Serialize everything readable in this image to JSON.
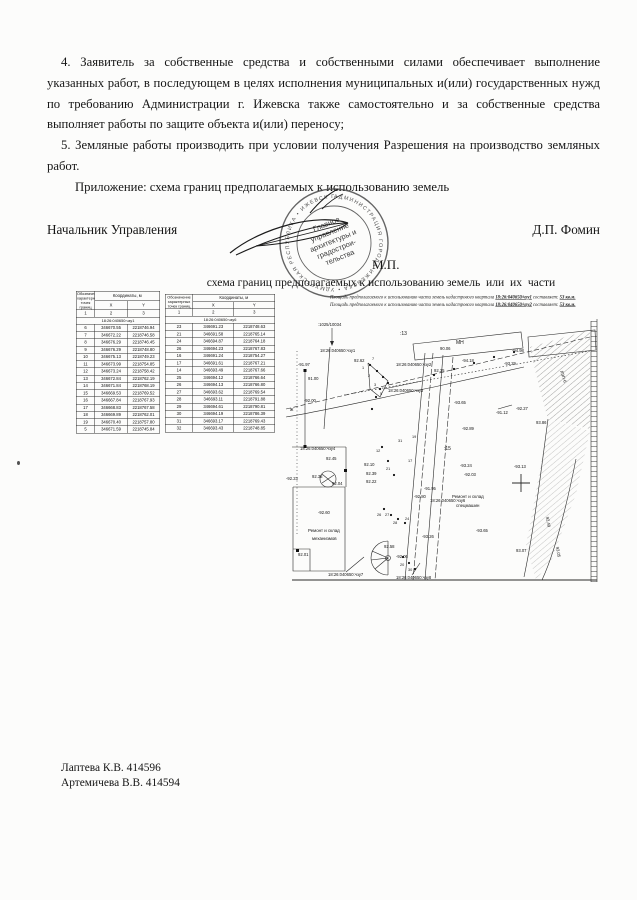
{
  "document": {
    "paragraph_4": "4. Заявитель за собственные средства и собственными силами обеспечивает выполнение указанных работ, в последующем в целях исполнения муниципальных и(или) государственных нужд по требованию Администрации г. Ижевска также самостоятельно и за собственные средства выполняет работы по защите объекта и(или) переносу;",
    "paragraph_5": "5. Земляные работы производить при условии получения  Разрешения на производство земляных работ.",
    "attachment_line": "Приложение: схема границ предполагаемых к использованию земель"
  },
  "signature_block": {
    "position_title": "Начальник Управления",
    "signer_name": "Д.П. Фомин",
    "seal_mark": "М.П."
  },
  "stamp": {
    "ring_text": "АДМИНИСТРАЦИЯ ГОРОДА ИЖЕВСКА • УДМУРТСКАЯ РЕСПУБЛИКА • ИЖЕВСК ГОРОДЛЭН • КЫЛДЫТЭТ",
    "center_lines": [
      "Главное",
      "управление",
      "архитектуры и",
      "градострои-",
      "тельства"
    ]
  },
  "scheme": {
    "title": "схема границ предполагаемых к использованию земель  или  их  части",
    "area_lines": [
      {
        "pre": "Площадь предполагаемого к использованию части земель кадастрового квартала",
        "cadastral": "18:26:040650/чзу1",
        "mid": "составляет:",
        "value": "53 кв.м."
      },
      {
        "pre": "Площадь предполагаемого к использованию части земель кадастрового квартала",
        "cadastral": "18:26:040650/чзу2",
        "mid": "составляет:",
        "value": "53 кв.м."
      }
    ]
  },
  "tables": [
    {
      "col1_header": "Обозначение характерных точек границ",
      "coords_header": "Координаты, м",
      "x_header": "X",
      "y_header": "Y",
      "num_row": [
        "1",
        "2",
        "3"
      ],
      "section": "18:26:040650:чзу1",
      "rows": [
        [
          "6",
          "346670.55",
          "2218746.94"
        ],
        [
          "7",
          "346672.22",
          "2218746.58"
        ],
        [
          "8",
          "346676.29",
          "2218746.45"
        ],
        [
          "9",
          "346676.29",
          "2218748.80"
        ],
        [
          "10",
          "346675.13",
          "2218749.23"
        ],
        [
          "11",
          "346673.99",
          "2218754.85"
        ],
        [
          "12",
          "346673.24",
          "2218758.42"
        ],
        [
          "13",
          "346672.84",
          "2218762.19"
        ],
        [
          "14",
          "346671.84",
          "2218768.19"
        ],
        [
          "15",
          "346669.53",
          "2218769.52"
        ],
        [
          "16",
          "346667.84",
          "2218767.93"
        ],
        [
          "17",
          "346668.83",
          "2218767.58"
        ],
        [
          "18",
          "346669.89",
          "2218762.01"
        ],
        [
          "19",
          "346670.40",
          "2218757.80"
        ],
        [
          "5",
          "346671.59",
          "2218745.84"
        ]
      ]
    },
    {
      "col1_header": "Обозначение характерных точек границ",
      "coords_header": "Координаты, м",
      "x_header": "X",
      "y_header": "Y",
      "num_row": [
        "1",
        "2",
        "3"
      ],
      "section": "18:26:040650:чзу6",
      "rows": [
        [
          "23",
          "346691.23",
          "2218748.63"
        ],
        [
          "21",
          "346691.58",
          "2218765.14"
        ],
        [
          "24",
          "346694.87",
          "2218764.18"
        ],
        [
          "26",
          "346694.23",
          "2218767.83"
        ],
        [
          "16",
          "346691.24",
          "2218754.27"
        ],
        [
          "17",
          "346691.61",
          "2218767.21"
        ],
        [
          "14",
          "346693.49",
          "2218767.66"
        ],
        [
          "25",
          "346694.12",
          "2218766.64"
        ],
        [
          "26",
          "346694.13",
          "2218766.80"
        ],
        [
          "27",
          "346693.62",
          "2218769.54"
        ],
        [
          "28",
          "346693.11",
          "2218791.88"
        ],
        [
          "29",
          "346694.61",
          "2218790.81"
        ],
        [
          "30",
          "346694.19",
          "2218786.39"
        ],
        [
          "31",
          "346693.17",
          "2218769.43"
        ],
        [
          "32",
          "346693.43",
          "2218748.85"
        ]
      ]
    }
  ],
  "map": {
    "labels": [
      {
        "t": ":1025/10034",
        "x": 34,
        "y": 7
      },
      {
        "t": "18:26:040650:чзу1",
        "x": 36,
        "y": 33
      },
      {
        "t": ":13",
        "x": 116,
        "y": 16,
        "s": 5
      },
      {
        "t": "90.06",
        "x": 156,
        "y": 31
      },
      {
        "t": "МН",
        "x": 172,
        "y": 25,
        "s": 5
      },
      {
        "t": "92.62",
        "x": 70,
        "y": 43
      },
      {
        "t": "-91.97",
        "x": 14,
        "y": 47
      },
      {
        "t": "91.00",
        "x": 24,
        "y": 61
      },
      {
        "t": "18:26:040650:чзу2",
        "x": 112,
        "y": 47
      },
      {
        "t": "92.35",
        "x": 150,
        "y": 53
      },
      {
        "t": "18:26:040650:чзу3",
        "x": 104,
        "y": 73
      },
      {
        "t": "-94.98",
        "x": 228,
        "y": 33
      },
      {
        "t": "-94.18",
        "x": 178,
        "y": 43
      },
      {
        "t": "-93.29",
        "x": 220,
        "y": 46
      },
      {
        "t": "-92.00",
        "x": 20,
        "y": 83
      },
      {
        "t": "-93.65",
        "x": 170,
        "y": 85
      },
      {
        "t": "-92.27",
        "x": 232,
        "y": 91
      },
      {
        "t": "-91.12",
        "x": 212,
        "y": 95
      },
      {
        "t": "-92.89",
        "x": 178,
        "y": 111
      },
      {
        "t": "93.86",
        "x": 252,
        "y": 105
      },
      {
        "t": "ж",
        "x": 6,
        "y": 92,
        "s": 5
      },
      {
        "t": "-92.23",
        "x": 2,
        "y": 161
      },
      {
        "t": "18:26:040650:чзу4",
        "x": 16,
        "y": 131
      },
      {
        "t": "92.45",
        "x": 42,
        "y": 141
      },
      {
        "t": ":15",
        "x": 160,
        "y": 131,
        "s": 5
      },
      {
        "t": "92.38",
        "x": 28,
        "y": 159
      },
      {
        "t": "92.10",
        "x": 80,
        "y": 147
      },
      {
        "t": "92.39",
        "x": 82,
        "y": 156
      },
      {
        "t": "92.22",
        "x": 82,
        "y": 164
      },
      {
        "t": "92.04",
        "x": 48,
        "y": 166
      },
      {
        "t": "-91.95",
        "x": 140,
        "y": 171
      },
      {
        "t": "-93.24",
        "x": 176,
        "y": 148
      },
      {
        "t": "-92.03",
        "x": 180,
        "y": 157
      },
      {
        "t": "-93.13",
        "x": 230,
        "y": 149
      },
      {
        "t": "-92.60",
        "x": 34,
        "y": 195
      },
      {
        "t": "-92.80",
        "x": 130,
        "y": 179
      },
      {
        "t": "18:26:040650:чзу6",
        "x": 146,
        "y": 183
      },
      {
        "t": "Ремонт и склад",
        "x": 24,
        "y": 213,
        "s": 4.4
      },
      {
        "t": "механизмов",
        "x": 28,
        "y": 221,
        "s": 4.4
      },
      {
        "t": "92.01",
        "x": 14,
        "y": 237
      },
      {
        "t": "Ремонт и склад",
        "x": 168,
        "y": 179,
        "s": 4.4
      },
      {
        "t": "спецмашин",
        "x": 172,
        "y": 188,
        "s": 4.4
      },
      {
        "t": "-93.65",
        "x": 192,
        "y": 213
      },
      {
        "t": "-93.26",
        "x": 138,
        "y": 219
      },
      {
        "t": "92.58",
        "x": 100,
        "y": 229
      },
      {
        "t": "-92.06",
        "x": 112,
        "y": 239
      },
      {
        "t": "93.07",
        "x": 232,
        "y": 233
      },
      {
        "t": "18:26:040650:чзу7",
        "x": 44,
        "y": 257
      },
      {
        "t": "18:26:040650:чзу8",
        "x": 112,
        "y": 260
      },
      {
        "t": "ЛЭП-6",
        "x": 276,
        "y": 52,
        "r": 72
      },
      {
        "t": "92.49",
        "x": 262,
        "y": 198,
        "r": 80
      },
      {
        "t": "93.05",
        "x": 272,
        "y": 228,
        "r": 80
      },
      {
        "t": "7",
        "x": 88,
        "y": 41,
        "s": 3.8
      },
      {
        "t": "1",
        "x": 78,
        "y": 50,
        "s": 3.8
      },
      {
        "t": "2",
        "x": 84,
        "y": 58,
        "s": 3.8
      },
      {
        "t": "3",
        "x": 90,
        "y": 67,
        "s": 3.8
      },
      {
        "t": "5",
        "x": 96,
        "y": 76,
        "s": 3.8
      },
      {
        "t": "12",
        "x": 92,
        "y": 133,
        "s": 3.8
      },
      {
        "t": "17",
        "x": 124,
        "y": 143,
        "s": 3.8
      },
      {
        "t": "21",
        "x": 102,
        "y": 151,
        "s": 3.8
      },
      {
        "t": "19",
        "x": 128,
        "y": 119,
        "s": 3.8
      },
      {
        "t": "31",
        "x": 114,
        "y": 123,
        "s": 3.8
      },
      {
        "t": "26",
        "x": 93,
        "y": 197,
        "s": 3.8
      },
      {
        "t": "27",
        "x": 101,
        "y": 197,
        "s": 3.8
      },
      {
        "t": "24",
        "x": 121,
        "y": 201,
        "s": 3.8
      },
      {
        "t": "28",
        "x": 109,
        "y": 205,
        "s": 3.8
      },
      {
        "t": "20",
        "x": 116,
        "y": 247,
        "s": 3.8
      },
      {
        "t": "30",
        "x": 124,
        "y": 252,
        "s": 3.8
      }
    ]
  },
  "footer": {
    "line1": "Лаптева К.В. 414596",
    "line2": "Артемичева В.В. 414594"
  }
}
